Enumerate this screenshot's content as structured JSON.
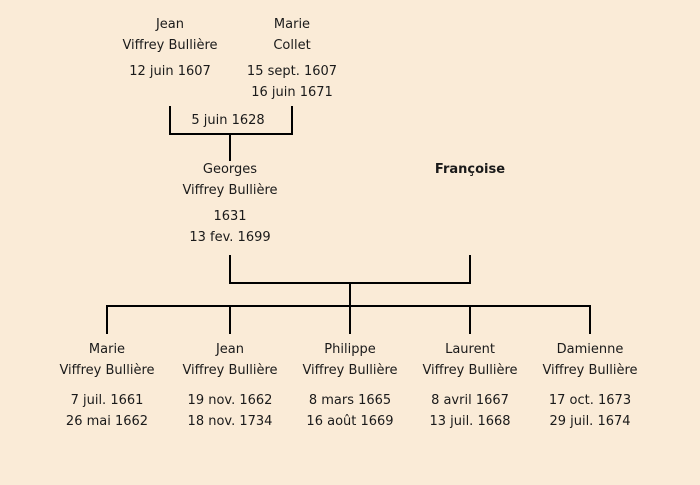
{
  "canvas": {
    "background_color": "#faebd7",
    "line_color": "#000000",
    "text_color": "#1a1a1a"
  },
  "tree": {
    "grandfather": {
      "first": "Jean",
      "last": "Viffrey Bullière",
      "birth": "12 juin 1607"
    },
    "grandmother": {
      "first": "Marie",
      "last": "Collet",
      "birth": "15 sept. 1607",
      "death": "16 juin 1671"
    },
    "marriage": {
      "date": "5 juin 1628"
    },
    "father": {
      "first": "Georges",
      "last": "Viffrey Bullière",
      "birth": "1631",
      "death": "13 fev. 1699"
    },
    "mother": {
      "first": "Françoise"
    },
    "children": [
      {
        "first": "Marie",
        "last": "Viffrey Bullière",
        "birth": "7 juil. 1661",
        "death": "26 mai 1662"
      },
      {
        "first": "Jean",
        "last": "Viffrey Bullière",
        "birth": "19 nov. 1662",
        "death": "18 nov. 1734"
      },
      {
        "first": "Philippe",
        "last": "Viffrey Bullière",
        "birth": "8 mars 1665",
        "death": "16 août 1669"
      },
      {
        "first": "Laurent",
        "last": "Viffrey Bullière",
        "birth": "8 avril 1667",
        "death": "13 juil. 1668"
      },
      {
        "first": "Damienne",
        "last": "Viffrey Bullière",
        "birth": "17 oct. 1673",
        "death": "29 juil. 1674"
      }
    ]
  }
}
